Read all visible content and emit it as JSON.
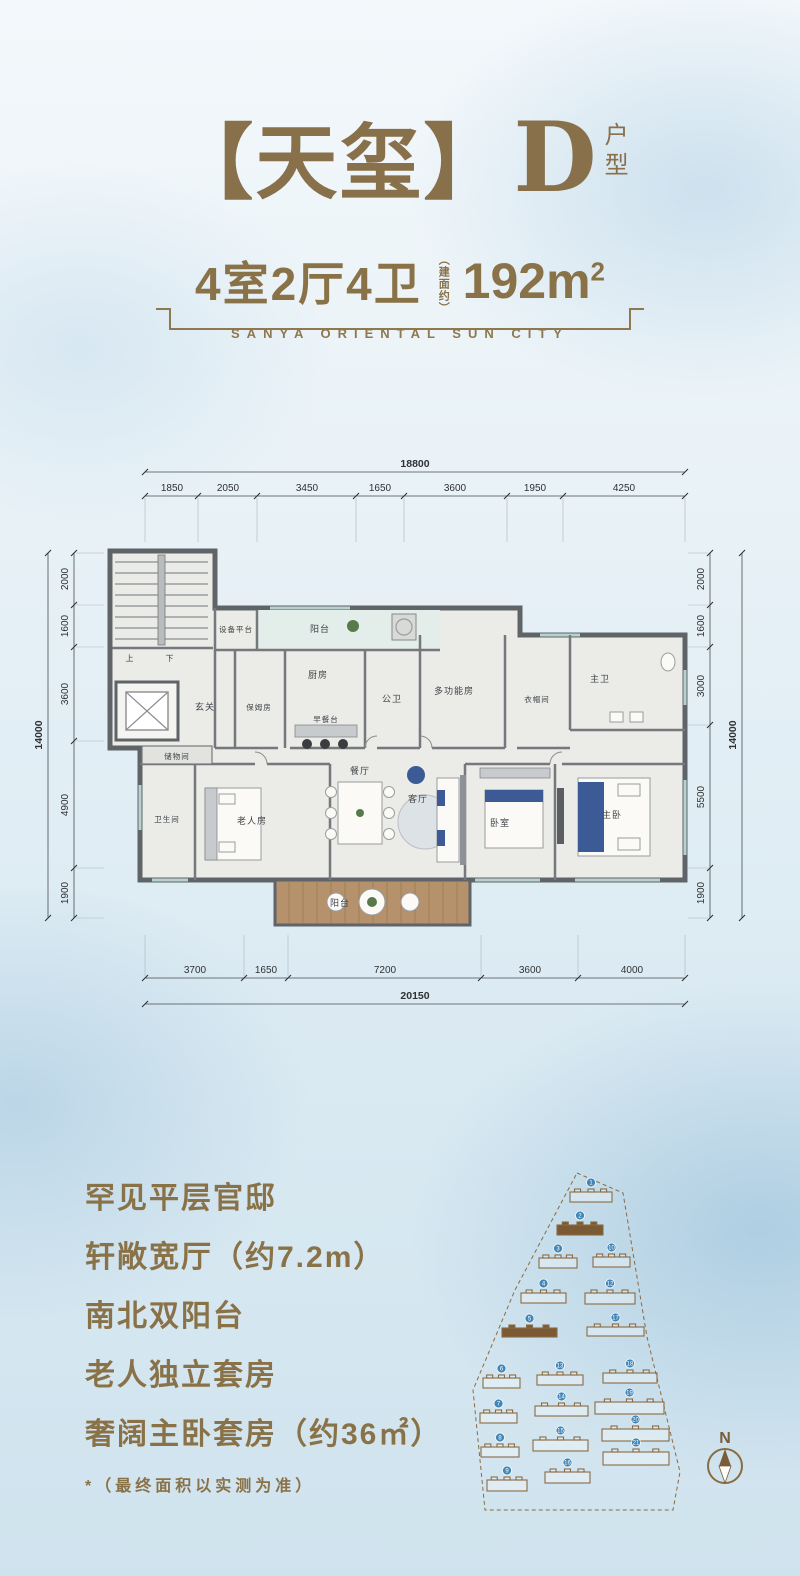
{
  "header": {
    "title": "【天玺】",
    "unit": "D",
    "suffix1": "户",
    "suffix2": "型"
  },
  "spec": {
    "rooms": "4室2厅4卫",
    "note": "（建面约）",
    "area": "192m",
    "area_sup": "2",
    "subtitle_en": "SANYA ORIENTAL SUN CITY"
  },
  "plan": {
    "dims": {
      "top": {
        "total": "18800",
        "segments": [
          "1850",
          "2050",
          "3450",
          "1650",
          "3600",
          "1950",
          "4250"
        ]
      },
      "bottom": {
        "total": "20150",
        "segments": [
          "3700",
          "1650",
          "7200",
          "3600",
          "4000"
        ]
      },
      "left": {
        "total": "14000",
        "segments": [
          "2000",
          "1600",
          "3600",
          "4900",
          "1900"
        ]
      },
      "right": {
        "total": "14000",
        "segments": [
          "2000",
          "1600",
          "3000",
          "5500",
          "1900"
        ]
      }
    },
    "rooms": [
      "设备平台",
      "阳台",
      "厨房",
      "玄关",
      "保姆房",
      "早餐台",
      "公卫",
      "多功能房",
      "衣帽间",
      "主卫",
      "储物间",
      "卫生间",
      "老人房",
      "餐厅",
      "客厅",
      "卧室",
      "主卧",
      "阳台",
      "上",
      "下"
    ]
  },
  "features": {
    "items": [
      "罕见平层官邸",
      "轩敞宽厅（约7.2m）",
      "南北双阳台",
      "老人独立套房",
      "奢阔主卧套房（约36㎡）"
    ],
    "footnote": "*（最终面积以实测为准）"
  },
  "siteplan": {
    "north_label": "N",
    "buildings": [
      {
        "n": "1",
        "x": 110,
        "y": 42,
        "w": 42,
        "h": 10
      },
      {
        "n": "2",
        "x": 97,
        "y": 75,
        "w": 46,
        "h": 10,
        "hl": true
      },
      {
        "n": "3",
        "x": 79,
        "y": 108,
        "w": 38,
        "h": 10
      },
      {
        "n": "10",
        "x": 133,
        "y": 107,
        "w": 37,
        "h": 10
      },
      {
        "n": "4",
        "x": 61,
        "y": 143,
        "w": 45,
        "h": 10
      },
      {
        "n": "12",
        "x": 125,
        "y": 143,
        "w": 50,
        "h": 11
      },
      {
        "n": "5",
        "x": 42,
        "y": 178,
        "w": 55,
        "h": 9,
        "hl": true
      },
      {
        "n": "17",
        "x": 127,
        "y": 177,
        "w": 57,
        "h": 9
      },
      {
        "n": "6",
        "x": 23,
        "y": 228,
        "w": 37,
        "h": 10
      },
      {
        "n": "13",
        "x": 77,
        "y": 225,
        "w": 46,
        "h": 10
      },
      {
        "n": "18",
        "x": 143,
        "y": 223,
        "w": 54,
        "h": 10
      },
      {
        "n": "7",
        "x": 20,
        "y": 263,
        "w": 37,
        "h": 10
      },
      {
        "n": "14",
        "x": 75,
        "y": 256,
        "w": 53,
        "h": 10
      },
      {
        "n": "19",
        "x": 135,
        "y": 252,
        "w": 69,
        "h": 12
      },
      {
        "n": "8",
        "x": 21,
        "y": 297,
        "w": 38,
        "h": 10
      },
      {
        "n": "15",
        "x": 73,
        "y": 290,
        "w": 55,
        "h": 11
      },
      {
        "n": "20",
        "x": 142,
        "y": 279,
        "w": 67,
        "h": 12
      },
      {
        "n": "9",
        "x": 27,
        "y": 330,
        "w": 40,
        "h": 11
      },
      {
        "n": "16",
        "x": 85,
        "y": 322,
        "w": 45,
        "h": 11
      },
      {
        "n": "21",
        "x": 143,
        "y": 302,
        "w": 66,
        "h": 13
      }
    ]
  },
  "colors": {
    "gold": "#8a7248",
    "wall": "#5f6468",
    "badge_blue": "#4286b8",
    "site_brown": "#8a6b42"
  }
}
